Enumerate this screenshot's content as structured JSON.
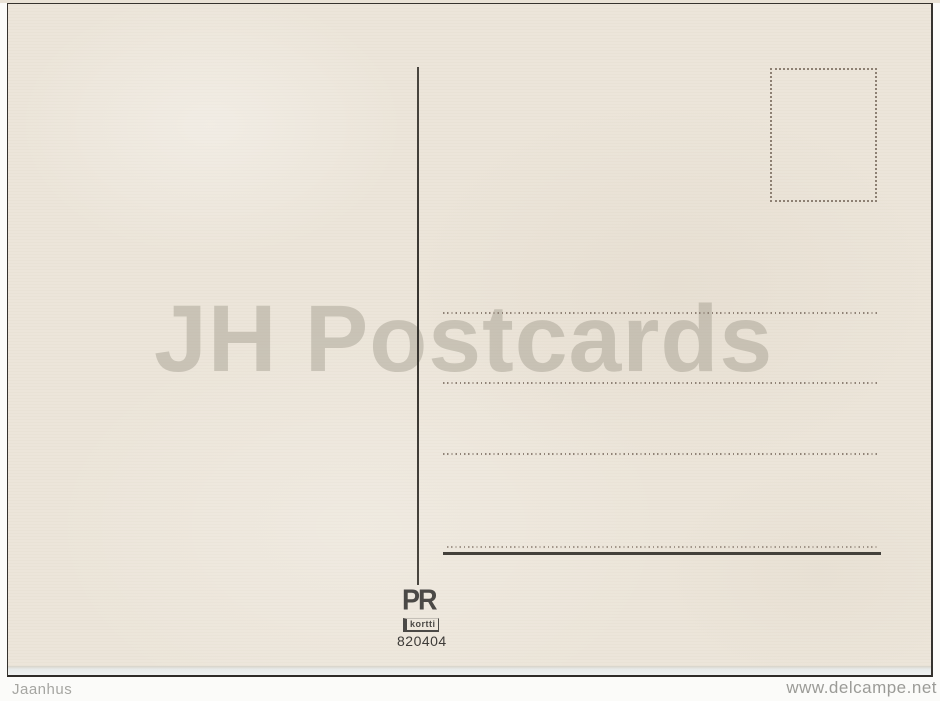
{
  "postcard": {
    "watermark_text": "JH Postcards",
    "publisher": {
      "initials": "PR",
      "name": "kortti"
    },
    "serial_number": "820404",
    "colors": {
      "card_background": "#ebe4d8",
      "watermark": "#cfcabf",
      "ink": "#3a3733",
      "dotted_line": "#8f8277",
      "logo": "#4b4946"
    }
  },
  "scan_overlay": {
    "seller_watermark": "Jaanhus",
    "site_watermark": "www.delcampe.net",
    "text_color": "#a0a09c"
  }
}
